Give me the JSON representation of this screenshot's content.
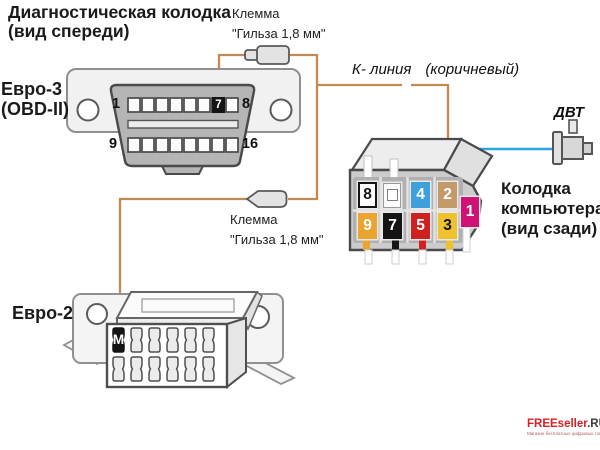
{
  "diagram": {
    "title_line1": "Диагностическая колодка",
    "title_line2": "(вид спереди)",
    "obd": {
      "label_line1": "Евро-3",
      "label_line2": "(OBD-II)",
      "pin_top_left": "1",
      "pin_top_right": "8",
      "pin_bottom_left": "9",
      "pin_bottom_right": "16",
      "highlight_pin": "7",
      "highlight_pin_color": "#141414"
    },
    "terminal_top": {
      "line1": "Клемма",
      "line2": "\"Гильза 1,8 мм\""
    },
    "terminal_bottom": {
      "line1": "Клемма",
      "line2": "\"Гильза 1,8 мм\""
    },
    "kline_label": "К- линия",
    "kline_color_note": "(коричневый)",
    "dvt_label": "ДВТ",
    "computer": {
      "label_line1": "Колодка",
      "label_line2": "компьютера",
      "label_line3": "(вид сзади)",
      "pins": [
        {
          "id": "8",
          "label": "8",
          "color": "#ffffff",
          "text_color": "#141414"
        },
        {
          "id": "blank",
          "label": "",
          "color": "#ffffff",
          "text_color": "#141414"
        },
        {
          "id": "4",
          "label": "4",
          "color": "#3f9fdd",
          "text_color": "#ffffff"
        },
        {
          "id": "2",
          "label": "2",
          "color": "#c49a6b",
          "text_color": "#ffffff"
        },
        {
          "id": "1",
          "label": "1",
          "color": "#cf1273",
          "text_color": "#ffffff"
        },
        {
          "id": "9",
          "label": "9",
          "color": "#e9a52f",
          "text_color": "#ffffff"
        },
        {
          "id": "7",
          "label": "7",
          "color": "#141414",
          "text_color": "#ffffff"
        },
        {
          "id": "5",
          "label": "5",
          "color": "#cf2020",
          "text_color": "#ffffff"
        },
        {
          "id": "3",
          "label": "3",
          "color": "#eec22f",
          "text_color": "#141414"
        }
      ]
    },
    "euro2": {
      "label": "Евро-2",
      "highlight_pin": "M",
      "highlight_pin_color": "#141414"
    },
    "wire_colors": {
      "k_line": "#c28a52",
      "dvt_line": "#2ea4de"
    }
  },
  "watermark": {
    "brand_red": "FREEseller",
    "brand_dark": ".RU",
    "tagline": "Магазин бесплатных цифровых товаров"
  }
}
